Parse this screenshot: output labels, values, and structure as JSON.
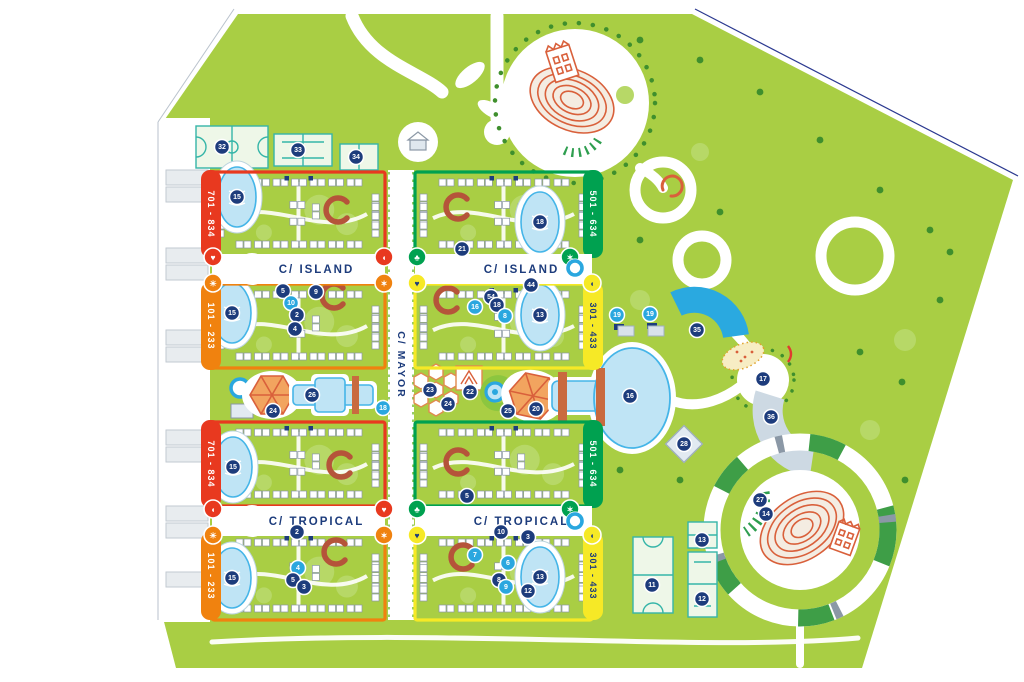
{
  "colors": {
    "park_green": "#a9ce44",
    "tree_light": "#b7d867",
    "tree_dark": "#3f8f2d",
    "navy": "#1d3c7c",
    "marker_blue": "#2aa7df",
    "pool_fill": "#bfe4f5",
    "pool_stroke": "#45b5e8",
    "block_red": "#e8391f",
    "block_orange": "#f0820f",
    "block_green": "#00a150",
    "block_yellow": "#f6e926",
    "structure_red": "#d9603b",
    "building_stroke": "#8b98a6",
    "court_teal": "#35b5a8"
  },
  "streets": [
    {
      "label": "C/ ISLAND",
      "x": 212,
      "y": 254,
      "w": 173,
      "h": 30,
      "dir": "h"
    },
    {
      "label": "C/ ISLAND",
      "x": 415,
      "y": 254,
      "w": 177,
      "h": 30,
      "dir": "h"
    },
    {
      "label": "C/ TROPICAL",
      "x": 212,
      "y": 506,
      "w": 173,
      "h": 30,
      "dir": "h"
    },
    {
      "label": "C/ TROPICAL",
      "x": 415,
      "y": 506,
      "w": 177,
      "h": 30,
      "dir": "h"
    },
    {
      "label": "C/ MAYOR",
      "x": 388,
      "y": 170,
      "w": 26,
      "h": 450,
      "dir": "v"
    }
  ],
  "blocks": [
    {
      "range": "701 - 834",
      "color": "#e8391f",
      "text_color": "#ffffff",
      "x": 212,
      "y": 172,
      "w": 173,
      "h": 84,
      "tab": "left",
      "pool": {
        "cx": 237,
        "cy": 197,
        "rx": 19,
        "ry": 30
      },
      "curve": {
        "x": 337,
        "y": 210
      }
    },
    {
      "range": "501 - 634",
      "color": "#00a150",
      "text_color": "#ffffff",
      "x": 415,
      "y": 172,
      "w": 177,
      "h": 84,
      "tab": "right",
      "pool": {
        "cx": 540,
        "cy": 222,
        "rx": 19,
        "ry": 30
      },
      "curve": {
        "x": 457,
        "y": 207
      }
    },
    {
      "range": "101 - 233",
      "color": "#f0820f",
      "text_color": "#ffffff",
      "x": 212,
      "y": 284,
      "w": 173,
      "h": 84,
      "tab": "left",
      "pool": {
        "cx": 232,
        "cy": 313,
        "rx": 19,
        "ry": 30
      },
      "curve": {
        "x": 333,
        "y": 296
      }
    },
    {
      "range": "301 - 433",
      "color": "#f6e926",
      "text_color": "#1d3c7c",
      "x": 415,
      "y": 284,
      "w": 177,
      "h": 84,
      "tab": "right",
      "pool": {
        "cx": 540,
        "cy": 315,
        "rx": 19,
        "ry": 30
      },
      "curve": {
        "x": 447,
        "y": 300
      }
    },
    {
      "range": "701 - 834",
      "color": "#e8391f",
      "text_color": "#ffffff",
      "x": 212,
      "y": 422,
      "w": 173,
      "h": 84,
      "tab": "left",
      "pool": {
        "cx": 233,
        "cy": 467,
        "rx": 19,
        "ry": 30
      },
      "curve": {
        "x": 340,
        "y": 465
      }
    },
    {
      "range": "501 - 634",
      "color": "#00a150",
      "text_color": "#ffffff",
      "x": 415,
      "y": 422,
      "w": 177,
      "h": 84,
      "tab": "right",
      "pool": null,
      "curve": {
        "x": 457,
        "y": 462
      }
    },
    {
      "range": "101 - 233",
      "color": "#f0820f",
      "text_color": "#ffffff",
      "x": 212,
      "y": 532,
      "w": 173,
      "h": 88,
      "tab": "left",
      "pool": {
        "cx": 232,
        "cy": 578,
        "rx": 19,
        "ry": 30
      },
      "curve": {
        "x": 335,
        "y": 552
      }
    },
    {
      "range": "301 - 433",
      "color": "#f6e926",
      "text_color": "#1d3c7c",
      "x": 415,
      "y": 532,
      "w": 177,
      "h": 88,
      "tab": "right",
      "pool": {
        "cx": 540,
        "cy": 577,
        "rx": 19,
        "ry": 30
      },
      "curve": {
        "x": 462,
        "y": 557
      }
    }
  ],
  "markers": [
    {
      "n": "32",
      "x": 222,
      "y": 147
    },
    {
      "n": "33",
      "x": 298,
      "y": 150
    },
    {
      "n": "34",
      "x": 356,
      "y": 157
    },
    {
      "n": "15",
      "x": 237,
      "y": 197
    },
    {
      "n": "18",
      "x": 540,
      "y": 222
    },
    {
      "n": "21",
      "x": 462,
      "y": 249
    },
    {
      "n": "5",
      "x": 283,
      "y": 291
    },
    {
      "n": "9",
      "x": 316,
      "y": 292
    },
    {
      "n": "10",
      "x": 291,
      "y": 303,
      "v": "blue"
    },
    {
      "n": "2",
      "x": 297,
      "y": 315
    },
    {
      "n": "4",
      "x": 295,
      "y": 329
    },
    {
      "n": "15",
      "x": 232,
      "y": 313
    },
    {
      "n": "44",
      "x": 531,
      "y": 285
    },
    {
      "n": "54",
      "x": 491,
      "y": 297
    },
    {
      "n": "18",
      "x": 497,
      "y": 305
    },
    {
      "n": "16",
      "x": 475,
      "y": 307,
      "v": "blue"
    },
    {
      "n": "8",
      "x": 505,
      "y": 316,
      "v": "blue"
    },
    {
      "n": "13",
      "x": 540,
      "y": 315
    },
    {
      "n": "19",
      "x": 617,
      "y": 315,
      "v": "blue"
    },
    {
      "n": "19",
      "x": 650,
      "y": 314,
      "v": "blue"
    },
    {
      "n": "26",
      "x": 312,
      "y": 395
    },
    {
      "n": "24",
      "x": 273,
      "y": 411
    },
    {
      "n": "23",
      "x": 430,
      "y": 390
    },
    {
      "n": "24",
      "x": 448,
      "y": 404
    },
    {
      "n": "22",
      "x": 470,
      "y": 392
    },
    {
      "n": "25",
      "x": 508,
      "y": 411
    },
    {
      "n": "20",
      "x": 536,
      "y": 409
    },
    {
      "n": "18",
      "x": 383,
      "y": 408,
      "v": "blue"
    },
    {
      "n": "16",
      "x": 630,
      "y": 396
    },
    {
      "n": "35",
      "x": 697,
      "y": 330
    },
    {
      "n": "17",
      "x": 763,
      "y": 379
    },
    {
      "n": "36",
      "x": 771,
      "y": 417
    },
    {
      "n": "28",
      "x": 684,
      "y": 444
    },
    {
      "n": "27",
      "x": 760,
      "y": 500
    },
    {
      "n": "14",
      "x": 766,
      "y": 514
    },
    {
      "n": "15",
      "x": 233,
      "y": 467
    },
    {
      "n": "5",
      "x": 467,
      "y": 496
    },
    {
      "n": "2",
      "x": 297,
      "y": 532
    },
    {
      "n": "15",
      "x": 232,
      "y": 578
    },
    {
      "n": "4",
      "x": 298,
      "y": 568,
      "v": "blue"
    },
    {
      "n": "5",
      "x": 293,
      "y": 580
    },
    {
      "n": "3",
      "x": 304,
      "y": 587
    },
    {
      "n": "10",
      "x": 501,
      "y": 532
    },
    {
      "n": "3",
      "x": 528,
      "y": 537
    },
    {
      "n": "7",
      "x": 475,
      "y": 555,
      "v": "blue"
    },
    {
      "n": "6",
      "x": 508,
      "y": 563,
      "v": "blue"
    },
    {
      "n": "8",
      "x": 499,
      "y": 580
    },
    {
      "n": "9",
      "x": 506,
      "y": 587,
      "v": "blue"
    },
    {
      "n": "12",
      "x": 528,
      "y": 591
    },
    {
      "n": "13",
      "x": 540,
      "y": 577
    },
    {
      "n": "13",
      "x": 702,
      "y": 540
    },
    {
      "n": "11",
      "x": 652,
      "y": 585
    },
    {
      "n": "12",
      "x": 702,
      "y": 599
    }
  ],
  "street_icons": [
    {
      "x": 213,
      "y": 257,
      "c": "#e8391f",
      "g": "♥"
    },
    {
      "x": 384,
      "y": 257,
      "c": "#e8391f",
      "g": "◖"
    },
    {
      "x": 213,
      "y": 283,
      "c": "#f0820f",
      "g": "☀"
    },
    {
      "x": 384,
      "y": 283,
      "c": "#f0820f",
      "g": "✶"
    },
    {
      "x": 417,
      "y": 257,
      "c": "#00a150",
      "g": "♣"
    },
    {
      "x": 570,
      "y": 257,
      "c": "#00a150",
      "g": "✶"
    },
    {
      "x": 417,
      "y": 283,
      "c": "#f6e926",
      "g": "♥",
      "tc": "#1d3c7c"
    },
    {
      "x": 592,
      "y": 283,
      "c": "#f6e926",
      "g": "◖",
      "tc": "#1d3c7c"
    },
    {
      "x": 575,
      "y": 268,
      "c": "ring"
    },
    {
      "x": 213,
      "y": 509,
      "c": "#e8391f",
      "g": "◖"
    },
    {
      "x": 384,
      "y": 509,
      "c": "#e8391f",
      "g": "♥"
    },
    {
      "x": 213,
      "y": 535,
      "c": "#f0820f",
      "g": "☀"
    },
    {
      "x": 384,
      "y": 535,
      "c": "#f0820f",
      "g": "✶"
    },
    {
      "x": 417,
      "y": 509,
      "c": "#00a150",
      "g": "♣"
    },
    {
      "x": 570,
      "y": 509,
      "c": "#00a150",
      "g": "✶"
    },
    {
      "x": 417,
      "y": 535,
      "c": "#f6e926",
      "g": "♥",
      "tc": "#1d3c7c"
    },
    {
      "x": 592,
      "y": 535,
      "c": "#f6e926",
      "g": "◖",
      "tc": "#1d3c7c"
    },
    {
      "x": 575,
      "y": 521,
      "c": "ring"
    }
  ]
}
